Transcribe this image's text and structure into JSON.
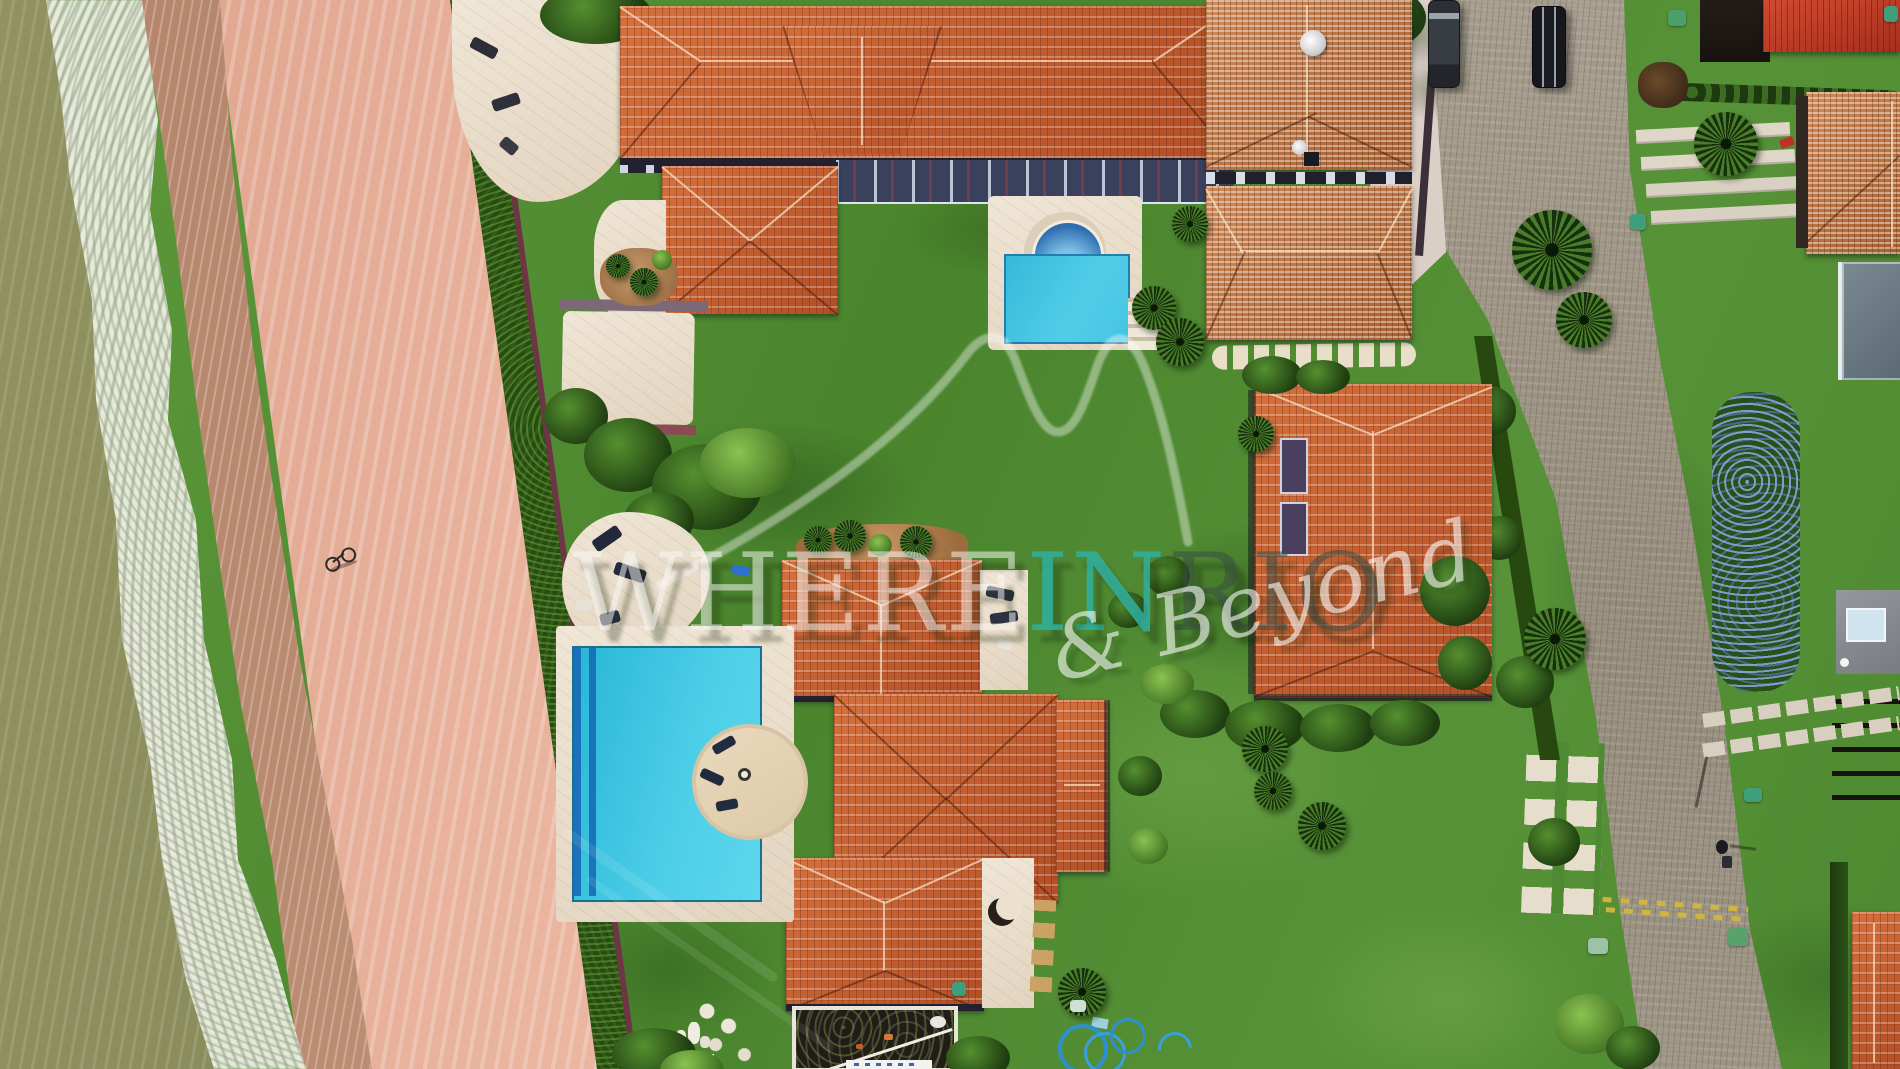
{
  "image": {
    "kind": "aerial-drone-photograph",
    "subject": "Beachfront villa compound with red clay-tile roofs, green lawns, two swimming pools, sandy beach with surf at left and cobblestone access road at right"
  },
  "watermark": {
    "where": "WHERE",
    "in": "IN",
    "rio": "RIO",
    "tagline": "& Beyond"
  },
  "palette": {
    "lawn": "#4f8c31",
    "roof_tile": "#c2582c",
    "roof_weathered": "#c57f4e",
    "sand": "#ecb39c",
    "wet_sand": "#bd8a70",
    "ocean": "#8a8c5f",
    "surf_foam": "#f3f5ec",
    "pool_water": "#35c3de",
    "arch_pool": "#2d6db0",
    "stone_deck": "#ecdfcf",
    "road": "#9c9283",
    "boundary_hedge": "#2e5519",
    "boundary_wall": "#6e3545",
    "watermark_teal": "#2fb0a0"
  },
  "inventory": {
    "villas_in_compound": 6,
    "swimming_pools": 2,
    "parked_cars": 2,
    "people": 1,
    "bicycles": 1
  }
}
